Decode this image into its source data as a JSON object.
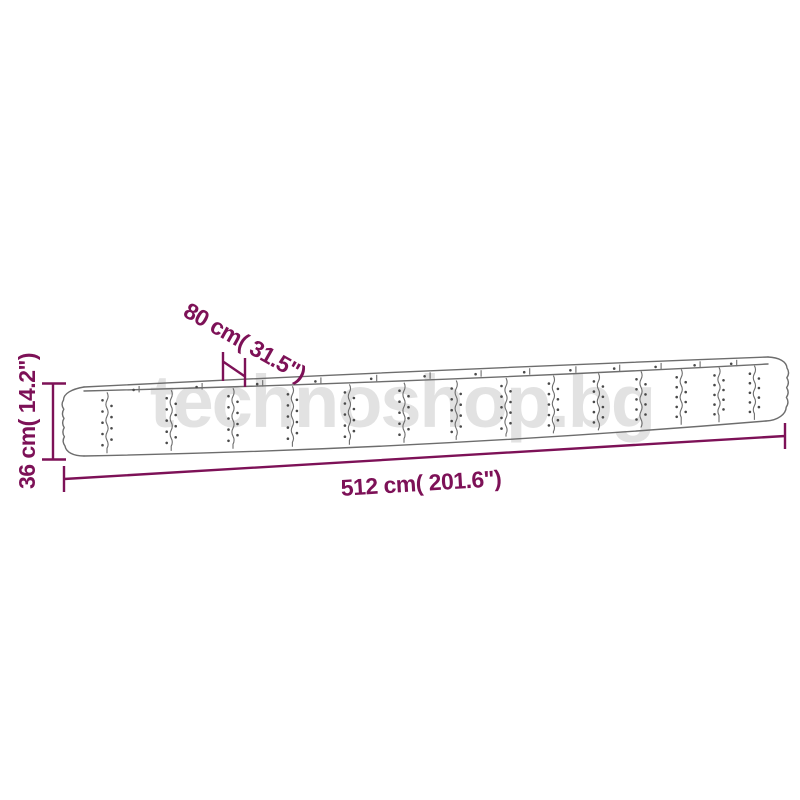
{
  "watermark": {
    "text": "technoshop.bg",
    "color": "#e2e2e2"
  },
  "diagram": {
    "line_color": "#6d6d6d",
    "rivet_color": "#4a4a4a",
    "dimension_color": "#7d1157",
    "dimensions": {
      "height": {
        "label": "36 cm( 14.2\")"
      },
      "width": {
        "label": "80 cm( 31.5\")"
      },
      "length": {
        "label": "512 cm( 201.6\")"
      }
    }
  }
}
